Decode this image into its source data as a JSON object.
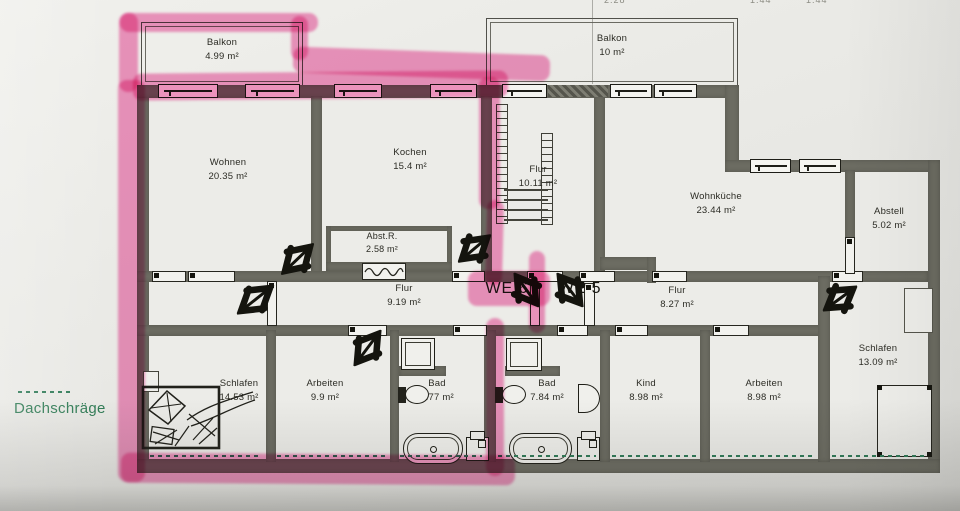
{
  "photo": {
    "top_dims": [
      "2.28",
      "1.44",
      "1.44"
    ]
  },
  "legend": {
    "label": "Dachschräge"
  },
  "unit_labels": {
    "we6": "WE 6",
    "we5": "WE 5"
  },
  "rooms": {
    "balkon_we6": {
      "name": "Balkon",
      "area": "4.99 m²"
    },
    "balkon_we5": {
      "name": "Balkon",
      "area": "10 m²"
    },
    "wohnen": {
      "name": "Wohnen",
      "area": "20.35 m²"
    },
    "kochen": {
      "name": "Kochen",
      "area": "15.4 m²"
    },
    "abstr": {
      "name": "Abst.R.",
      "area": "2.58 m²"
    },
    "flur_treppe": {
      "name": "Flur",
      "area": "10.11 m²"
    },
    "wohnkueche": {
      "name": "Wohnküche",
      "area": "23.44 m²"
    },
    "abstell": {
      "name": "Abstell",
      "area": "5.02 m²"
    },
    "flur_we6": {
      "name": "Flur",
      "area": "9.19 m²"
    },
    "flur_we5": {
      "name": "Flur",
      "area": "8.27 m²"
    },
    "schlafen_we6": {
      "name": "Schlafen",
      "area": "14.53 m²"
    },
    "arbeiten_we6": {
      "name": "Arbeiten",
      "area": "9.9 m²"
    },
    "bad_we6": {
      "name": "Bad",
      "area": "7.77 m²"
    },
    "bad_we5": {
      "name": "Bad",
      "area": "7.84 m²"
    },
    "kind": {
      "name": "Kind",
      "area": "8.98 m²"
    },
    "arbeiten_we5": {
      "name": "Arbeiten",
      "area": "8.98 m²"
    },
    "schlafen_we5": {
      "name": "Schlafen",
      "area": "13.09 m²"
    }
  },
  "colors": {
    "highlight": "#ee3d95",
    "wall": "#6c6c62",
    "dachschraege": "#2f7a57",
    "paper": "#eaeae6"
  }
}
